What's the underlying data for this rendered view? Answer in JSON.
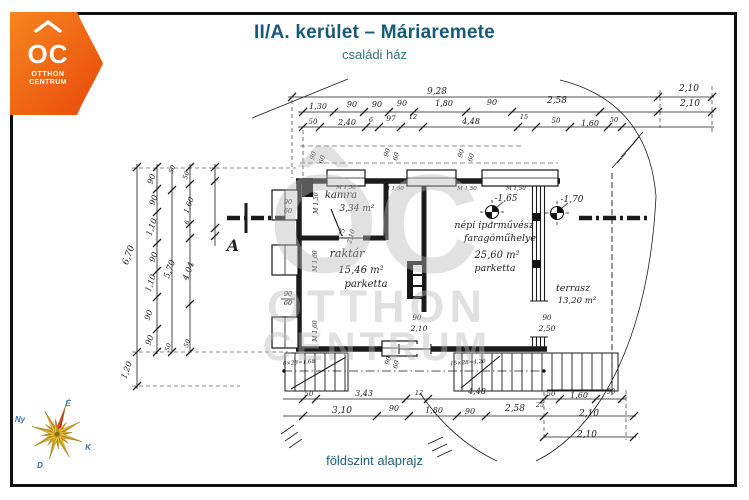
{
  "header": {
    "title": "II/A. kerület – Máriaremete",
    "subtitle": "családi ház"
  },
  "footer": {
    "caption": "földszint alaprajz"
  },
  "logo": {
    "mark": "OC",
    "line1": "OTTHON",
    "line2": "CENTRUM"
  },
  "watermark": {
    "mark": "ÔC",
    "line1": "OTTHON",
    "line2": "CENTRUM"
  },
  "compass": {
    "n": "É",
    "w": "Ny",
    "e": "K",
    "s": "D"
  },
  "colors": {
    "brand_orange_light": "#f6861f",
    "brand_orange_dark": "#e8490b",
    "title_teal": "#175a78",
    "subtitle_teal": "#2d7585",
    "ink": "#1b1b1b",
    "watermark_gray": "#c9c9c9",
    "gold_light": "#edc33c",
    "gold_dark": "#c9971c",
    "red_light": "#e04326",
    "red_dark": "#c0260f",
    "compass_label_blue": "#3a6ea8"
  },
  "plan": {
    "rooms": [
      {
        "name": "kamra",
        "area": "3,34 m²"
      },
      {
        "name": "raktár",
        "area": "15,46 m²",
        "floor": "parketta"
      },
      {
        "name": "népi iparművész faragóműhelye",
        "area": "25,60 m²",
        "floor": "parketta"
      },
      {
        "name": "terrasz",
        "area": "13,20 m²"
      }
    ],
    "levels": [
      "-1,65",
      "-1,70"
    ],
    "section_label": "A",
    "labels": [
      {
        "x": 437,
        "y": 94,
        "t": "9,28",
        "s": 9
      },
      {
        "x": 689,
        "y": 91,
        "t": "2,10",
        "s": 9
      },
      {
        "x": 318,
        "y": 109,
        "t": "1,30"
      },
      {
        "x": 352,
        "y": 107,
        "t": "90"
      },
      {
        "x": 377,
        "y": 107,
        "t": "90"
      },
      {
        "x": 402,
        "y": 106,
        "t": "90"
      },
      {
        "x": 444,
        "y": 106,
        "t": "1,80"
      },
      {
        "x": 492,
        "y": 105,
        "t": "90"
      },
      {
        "x": 557,
        "y": 103,
        "t": "2,58",
        "s": 9
      },
      {
        "x": 690,
        "y": 106,
        "t": "2,10",
        "s": 9
      },
      {
        "x": 313,
        "y": 124,
        "t": "50",
        "s": 7
      },
      {
        "x": 347,
        "y": 125,
        "t": "2,40"
      },
      {
        "x": 371,
        "y": 122,
        "t": "6",
        "s": 6.5
      },
      {
        "x": 391,
        "y": 121,
        "t": "97",
        "s": 7.5
      },
      {
        "x": 413,
        "y": 119,
        "t": "12",
        "s": 6.5
      },
      {
        "x": 471,
        "y": 124,
        "t": "4,48"
      },
      {
        "x": 524,
        "y": 119,
        "t": "15",
        "s": 6.5
      },
      {
        "x": 556,
        "y": 123,
        "t": "50",
        "s": 7
      },
      {
        "x": 590,
        "y": 126,
        "t": "1,60"
      },
      {
        "x": 614,
        "y": 122,
        "t": "50",
        "s": 6.5
      },
      {
        "x": 131,
        "y": 256,
        "t": "6,70",
        "r": -70,
        "s": 9
      },
      {
        "x": 154,
        "y": 180,
        "t": "90",
        "r": -70
      },
      {
        "x": 156,
        "y": 201,
        "t": "90",
        "r": -70
      },
      {
        "x": 154,
        "y": 228,
        "t": "1,10",
        "r": -70
      },
      {
        "x": 156,
        "y": 258,
        "t": "90",
        "r": -70
      },
      {
        "x": 153,
        "y": 284,
        "t": "1,10",
        "r": -70
      },
      {
        "x": 151,
        "y": 316,
        "t": "90",
        "r": -70
      },
      {
        "x": 152,
        "y": 341,
        "t": "90",
        "r": -70
      },
      {
        "x": 129,
        "y": 371,
        "t": "1,20",
        "r": -70
      },
      {
        "x": 172,
        "y": 270,
        "t": "5,70",
        "r": -70,
        "s": 8.5
      },
      {
        "x": 188,
        "y": 176,
        "t": "50",
        "r": -70,
        "s": 6.5
      },
      {
        "x": 191,
        "y": 206,
        "t": "1,60",
        "r": -70,
        "s": 7.5
      },
      {
        "x": 189,
        "y": 223,
        "t": "6",
        "r": -70,
        "s": 6.5
      },
      {
        "x": 191,
        "y": 272,
        "t": "4,04",
        "r": -70,
        "s": 8.5
      },
      {
        "x": 170,
        "y": 348,
        "t": "50",
        "r": -70,
        "s": 6.5
      },
      {
        "x": 189,
        "y": 344,
        "t": "50",
        "r": -70,
        "s": 6.5
      },
      {
        "x": 174,
        "y": 170,
        "t": "50",
        "r": -70,
        "s": 6.5
      },
      {
        "x": 288,
        "y": 204,
        "t": "90",
        "s": 6.5
      },
      {
        "x": 288,
        "y": 213,
        "t": "60",
        "s": 6.5
      },
      {
        "x": 288,
        "y": 296,
        "t": "90",
        "s": 6.5
      },
      {
        "x": 288,
        "y": 305,
        "t": "60",
        "s": 6.5
      },
      {
        "x": 318,
        "y": 203,
        "t": "M 1,50",
        "r": -90,
        "s": 6
      },
      {
        "x": 317,
        "y": 261,
        "t": "M 1,60",
        "r": -90,
        "s": 6
      },
      {
        "x": 317,
        "y": 331,
        "t": "M 1,60",
        "r": -90,
        "s": 6
      },
      {
        "x": 315,
        "y": 156,
        "t": "90",
        "r": -75,
        "s": 6.5
      },
      {
        "x": 324,
        "y": 160,
        "t": "60",
        "r": -75,
        "s": 6.5
      },
      {
        "x": 389,
        "y": 153,
        "t": "90",
        "r": -75,
        "s": 6.5
      },
      {
        "x": 398,
        "y": 157,
        "t": "60",
        "r": -75,
        "s": 6.5
      },
      {
        "x": 463,
        "y": 154,
        "t": "90",
        "r": -75,
        "s": 6.5
      },
      {
        "x": 473,
        "y": 158,
        "t": "60",
        "r": -75,
        "s": 6.5
      },
      {
        "x": 346,
        "y": 189,
        "t": "M 1,50",
        "s": 5.5
      },
      {
        "x": 394,
        "y": 190,
        "t": "M 1,50",
        "s": 5.5
      },
      {
        "x": 467,
        "y": 190,
        "t": "M 1,50",
        "s": 5.5
      },
      {
        "x": 516,
        "y": 190,
        "t": "M 1,50",
        "s": 5.5
      },
      {
        "x": 390,
        "y": 361,
        "t": "90",
        "r": -75,
        "s": 6.5
      },
      {
        "x": 398,
        "y": 365,
        "t": "60",
        "r": -75,
        "s": 6.5
      },
      {
        "x": 547,
        "y": 320,
        "t": "90",
        "s": 7
      },
      {
        "x": 547,
        "y": 331,
        "t": "2,50",
        "s": 7.5
      },
      {
        "x": 417,
        "y": 320,
        "t": "90",
        "s": 7
      },
      {
        "x": 419,
        "y": 331,
        "t": "2,10",
        "s": 7.5
      },
      {
        "x": 344,
        "y": 233,
        "t": "75",
        "r": -75,
        "s": 6.5
      },
      {
        "x": 353,
        "y": 237,
        "t": "2,10",
        "r": -75,
        "s": 6.5
      },
      {
        "x": 341,
        "y": 198,
        "t": "kamra",
        "s": 10
      },
      {
        "x": 357,
        "y": 211,
        "t": "3,34 m²",
        "s": 9
      },
      {
        "x": 347,
        "y": 257,
        "t": "raktár",
        "s": 11
      },
      {
        "x": 361,
        "y": 273,
        "t": "15,46 m²",
        "s": 10
      },
      {
        "x": 366,
        "y": 287,
        "t": "parketta",
        "s": 10
      },
      {
        "x": 494,
        "y": 228,
        "t": "népi iparművész",
        "s": 9.5
      },
      {
        "x": 500,
        "y": 241,
        "t": "faragóműhelye",
        "s": 9.5
      },
      {
        "x": 497,
        "y": 258,
        "t": "25,60 m²",
        "s": 10
      },
      {
        "x": 495,
        "y": 271,
        "t": "parketta",
        "s": 9.5
      },
      {
        "x": 573,
        "y": 291,
        "t": "terrasz",
        "s": 9.5
      },
      {
        "x": 577,
        "y": 303,
        "t": "13,20 m²",
        "s": 8.5
      },
      {
        "x": 506,
        "y": 201,
        "t": "-1,65",
        "s": 9
      },
      {
        "x": 572,
        "y": 202,
        "t": "-1,70",
        "s": 9
      },
      {
        "x": 233,
        "y": 251,
        "t": "A",
        "s": 16,
        "b": 1
      },
      {
        "x": 299,
        "y": 364,
        "t": "6×28=1,68",
        "s": 5.5,
        "r": -4
      },
      {
        "x": 468,
        "y": 364,
        "t": "15×28=4,20",
        "s": 5.5,
        "r": -4
      },
      {
        "x": 309,
        "y": 396,
        "t": "50",
        "s": 7
      },
      {
        "x": 364,
        "y": 396,
        "t": "3,43"
      },
      {
        "x": 419,
        "y": 395,
        "t": "12",
        "s": 6.5
      },
      {
        "x": 477,
        "y": 394,
        "t": "4,48"
      },
      {
        "x": 551,
        "y": 396,
        "t": "50",
        "s": 7
      },
      {
        "x": 579,
        "y": 398,
        "t": "1,60"
      },
      {
        "x": 611,
        "y": 394,
        "t": "50",
        "s": 7
      },
      {
        "x": 540,
        "y": 407,
        "t": "25",
        "s": 6.5
      },
      {
        "x": 342,
        "y": 413,
        "t": "3,10",
        "s": 9
      },
      {
        "x": 394,
        "y": 411,
        "t": "90"
      },
      {
        "x": 434,
        "y": 413,
        "t": "1,80"
      },
      {
        "x": 470,
        "y": 414,
        "t": "90"
      },
      {
        "x": 515,
        "y": 411,
        "t": "2,58",
        "s": 9
      },
      {
        "x": 589,
        "y": 416,
        "t": "2,10",
        "s": 9
      },
      {
        "x": 587,
        "y": 437,
        "t": "2,10",
        "s": 9
      }
    ],
    "ticks": [
      [
        292,
        97
      ],
      [
        658,
        97
      ],
      [
        712,
        97
      ],
      [
        303,
        112
      ],
      [
        334,
        112
      ],
      [
        364,
        112
      ],
      [
        389,
        112
      ],
      [
        414,
        112
      ],
      [
        466,
        112
      ],
      [
        512,
        112
      ],
      [
        600,
        112
      ],
      [
        658,
        112
      ],
      [
        712,
        112
      ],
      [
        303,
        127
      ],
      [
        320,
        127
      ],
      [
        366,
        127
      ],
      [
        379,
        127
      ],
      [
        401,
        127
      ],
      [
        423,
        127
      ],
      [
        518,
        127
      ],
      [
        536,
        127
      ],
      [
        570,
        127
      ],
      [
        608,
        127
      ],
      [
        622,
        127
      ],
      [
        303,
        399
      ],
      [
        316,
        399
      ],
      [
        406,
        399
      ],
      [
        428,
        399
      ],
      [
        544,
        399
      ],
      [
        560,
        399
      ],
      [
        596,
        399
      ],
      [
        622,
        399
      ],
      [
        303,
        416
      ],
      [
        377,
        416
      ],
      [
        409,
        416
      ],
      [
        457,
        416
      ],
      [
        486,
        416
      ],
      [
        544,
        416
      ],
      [
        634,
        416
      ],
      [
        544,
        437
      ],
      [
        634,
        437
      ],
      [
        137,
        167
      ],
      [
        137,
        352
      ],
      [
        137,
        386
      ],
      [
        157,
        167
      ],
      [
        157,
        189
      ],
      [
        157,
        212
      ],
      [
        157,
        243
      ],
      [
        157,
        271
      ],
      [
        157,
        297
      ],
      [
        157,
        329
      ],
      [
        157,
        352
      ],
      [
        172,
        190
      ],
      [
        172,
        352
      ],
      [
        190,
        167
      ],
      [
        190,
        184
      ],
      [
        190,
        224
      ],
      [
        190,
        238
      ],
      [
        190,
        304
      ],
      [
        190,
        352
      ],
      [
        215,
        167
      ],
      [
        215,
        181
      ],
      [
        215,
        228
      ],
      [
        215,
        236
      ]
    ]
  }
}
